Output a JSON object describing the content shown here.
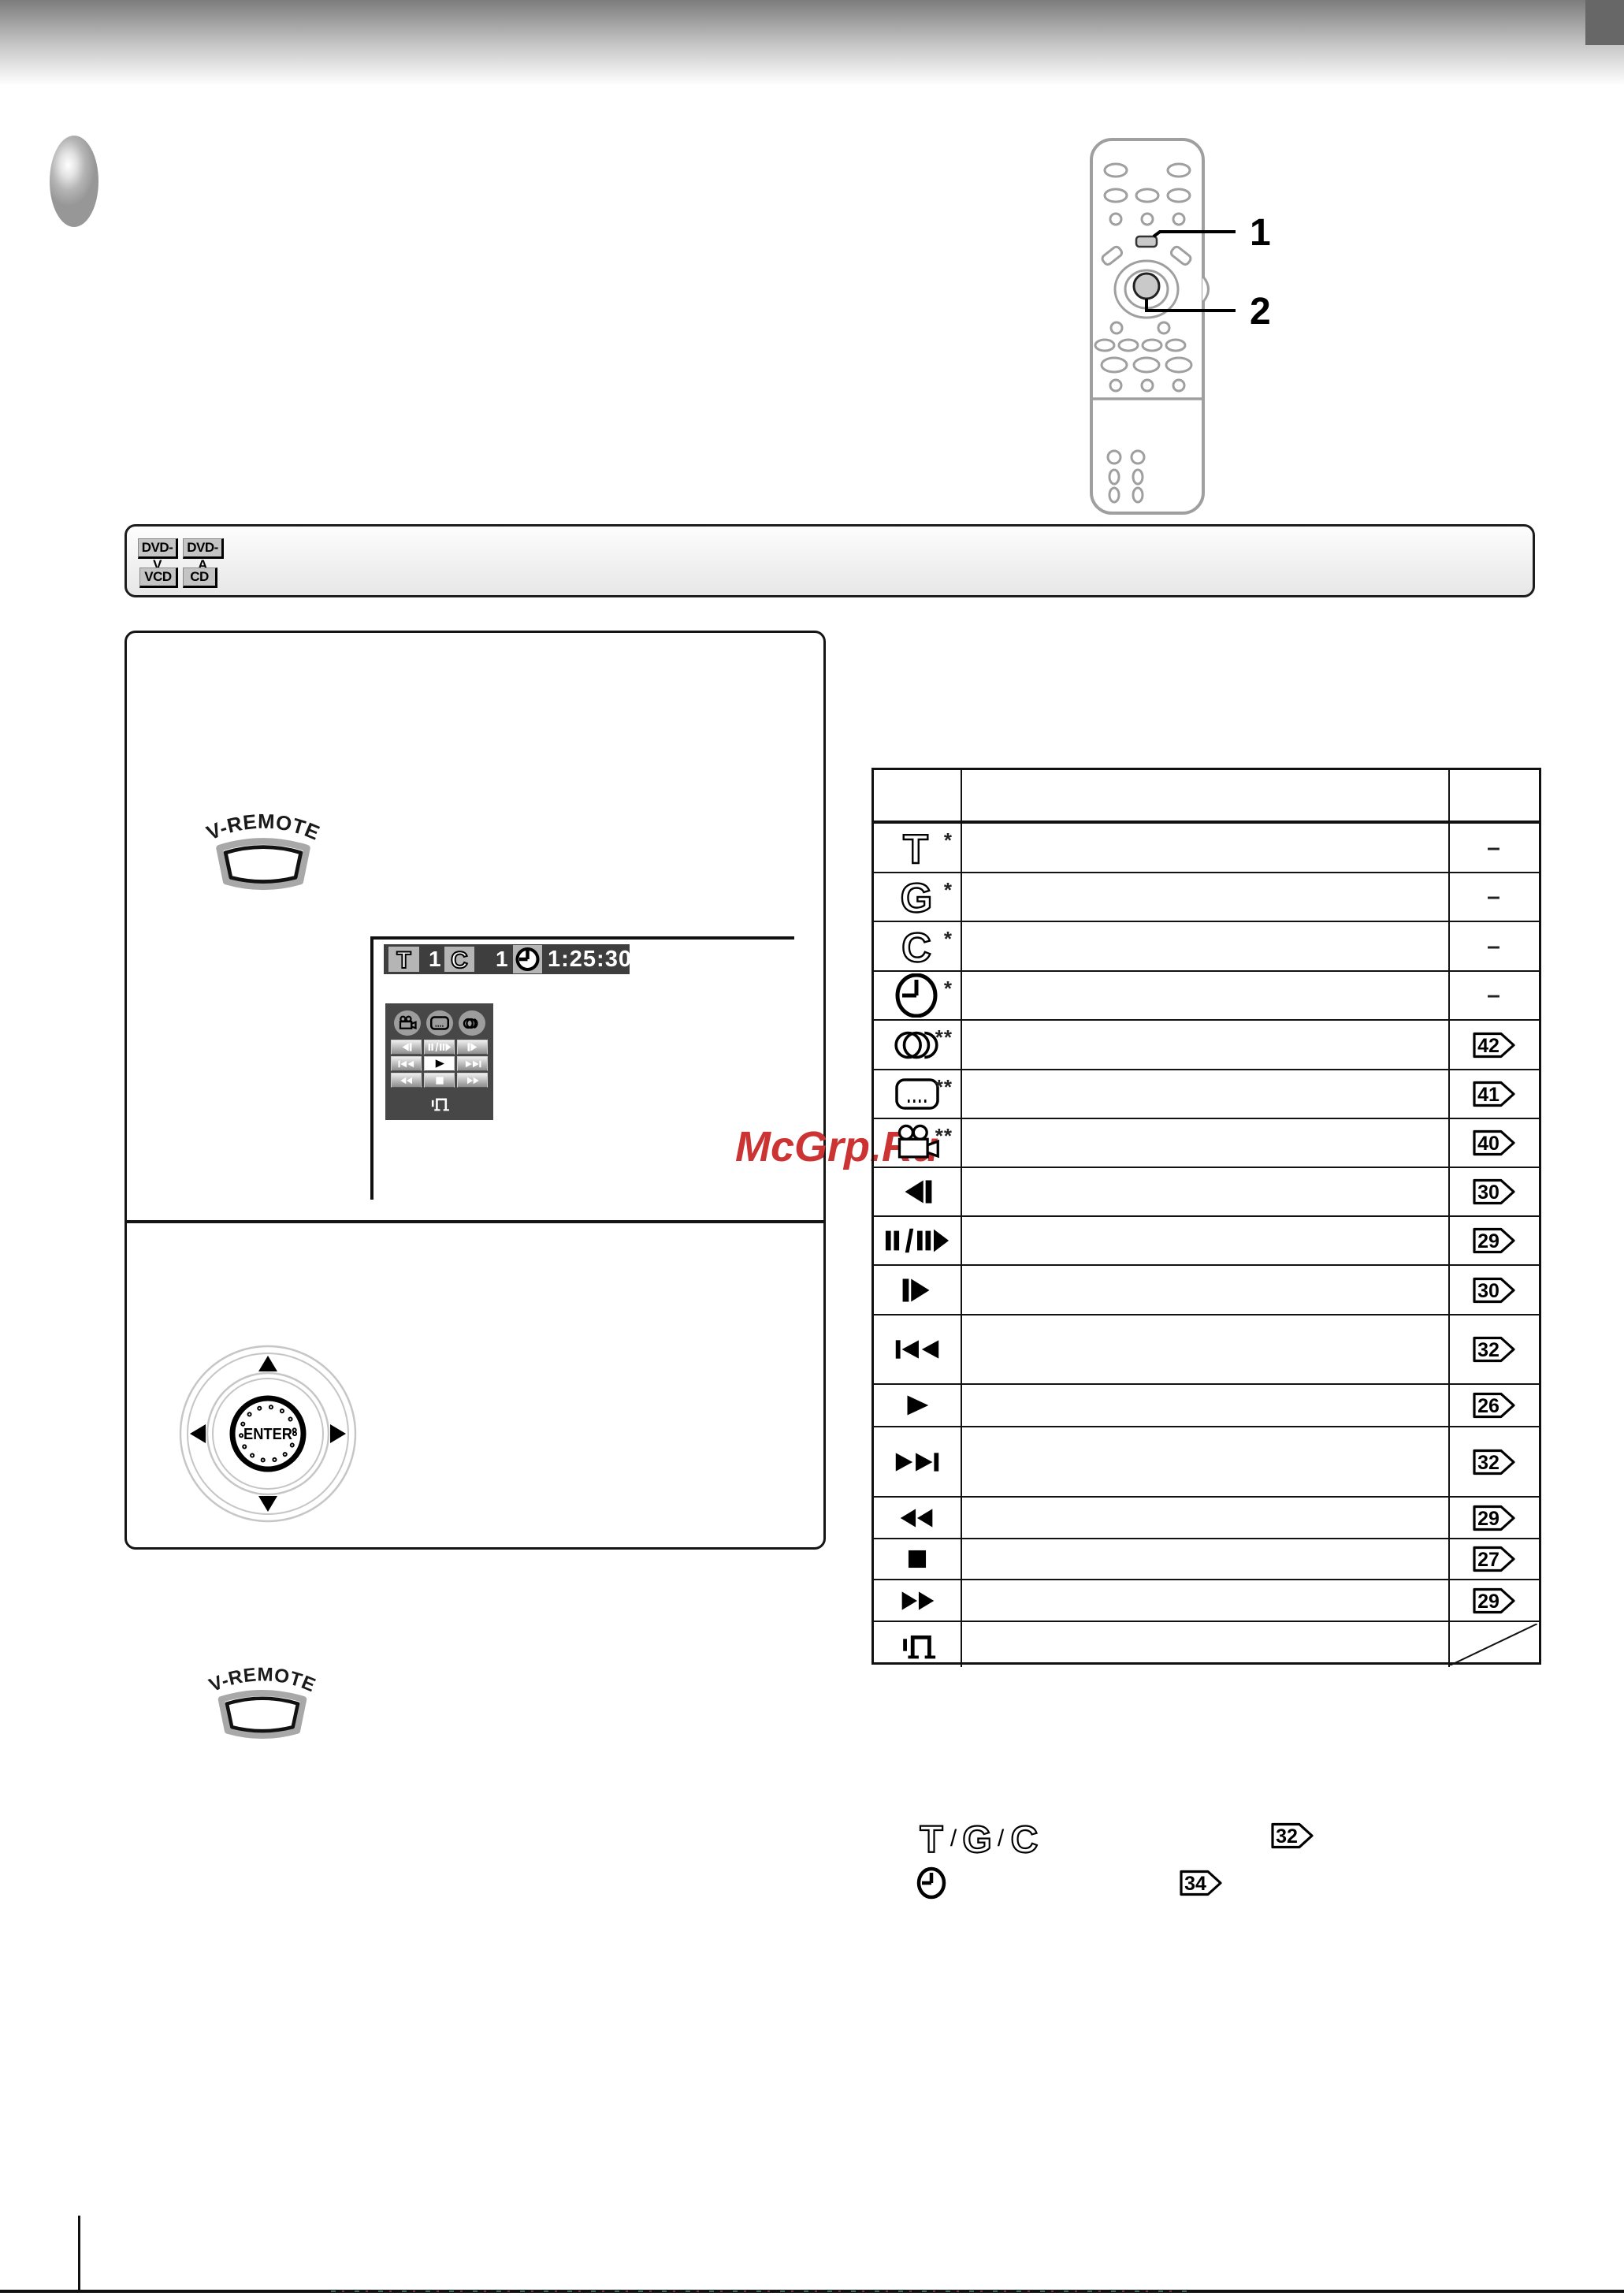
{
  "callouts": {
    "one": "1",
    "two": "2"
  },
  "disc_badges": {
    "dvd_v": "DVD-V",
    "dvd_a": "DVD-A",
    "vcd": "VCD",
    "cd": "CD"
  },
  "v_remote": {
    "label": "V-REMOTE"
  },
  "osd": {
    "title_label": "T",
    "title_number": "1",
    "chapter_label": "C",
    "chapter_number": "1",
    "time": "1:25:30"
  },
  "nav_pad": {
    "enter": "ENTER"
  },
  "watermark": {
    "text": "McGrp.Ru",
    "color": "#cc3333"
  },
  "table": {
    "rows": [
      {
        "icon": "title-icon",
        "marker": "*",
        "page": "–"
      },
      {
        "icon": "group-icon",
        "marker": "*",
        "page": "–"
      },
      {
        "icon": "chapter-icon",
        "marker": "*",
        "page": "–"
      },
      {
        "icon": "time-icon",
        "marker": "*",
        "page": "–"
      },
      {
        "icon": "audio-icon",
        "marker": "**",
        "page": "42"
      },
      {
        "icon": "subtitle-icon",
        "marker": "**",
        "page": "41"
      },
      {
        "icon": "angle-icon",
        "marker": "**",
        "page": "40"
      },
      {
        "icon": "step-reverse-icon",
        "marker": "",
        "page": "30"
      },
      {
        "icon": "pause-slow-icon",
        "marker": "",
        "page": "29"
      },
      {
        "icon": "step-forward-icon",
        "marker": "",
        "page": "30"
      },
      {
        "icon": "skip-back-icon",
        "marker": "",
        "page": "32"
      },
      {
        "icon": "play-icon",
        "marker": "",
        "page": "26"
      },
      {
        "icon": "skip-forward-icon",
        "marker": "",
        "page": "32"
      },
      {
        "icon": "rewind-icon",
        "marker": "",
        "page": "29"
      },
      {
        "icon": "stop-icon",
        "marker": "",
        "page": "27"
      },
      {
        "icon": "fast-forward-icon",
        "marker": "",
        "page": "29"
      },
      {
        "icon": "digest-icon",
        "marker": "",
        "page": ""
      }
    ]
  },
  "footer_refs": {
    "title": "T",
    "sep1": "/",
    "group": "G",
    "sep2": "/",
    "chapter": "C",
    "page_a": "32",
    "page_b": "34"
  },
  "colors": {
    "accent_red": "#cc3333",
    "osd_bg": "#3e3e3e",
    "panel_bg": "#474747",
    "table_border": "#111111"
  }
}
